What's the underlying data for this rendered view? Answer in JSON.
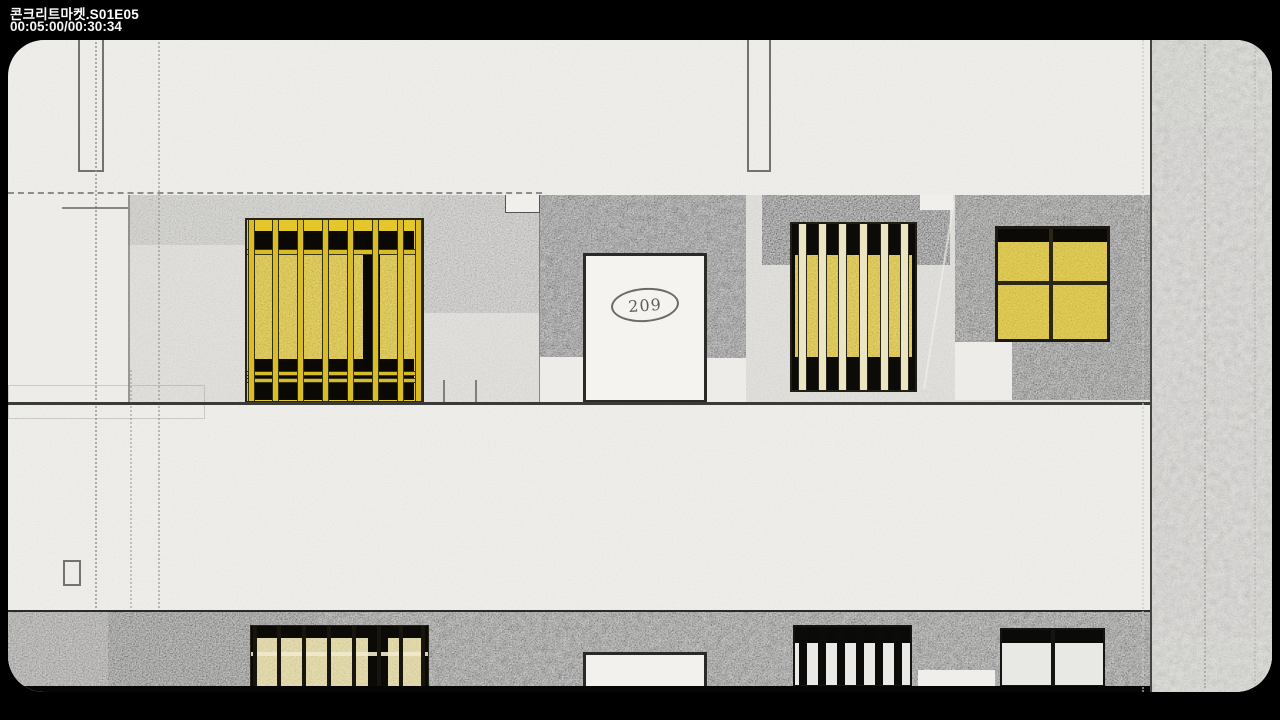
{
  "player": {
    "title": "콘크리트마켓.S01E05",
    "timecode": "00:05:00/00:30:34"
  },
  "scene": {
    "door_label": "209"
  },
  "colors": {
    "letterbox": "#000000",
    "paper": "#f0efeb",
    "wall_gray": "#e2e1dd",
    "concrete_dark": "#403f3d",
    "window_yellow": "#e7cb31",
    "window_pale_yellow": "#e8dea2",
    "bar_black": "#0b0905",
    "door_white": "#f4f3ef"
  }
}
